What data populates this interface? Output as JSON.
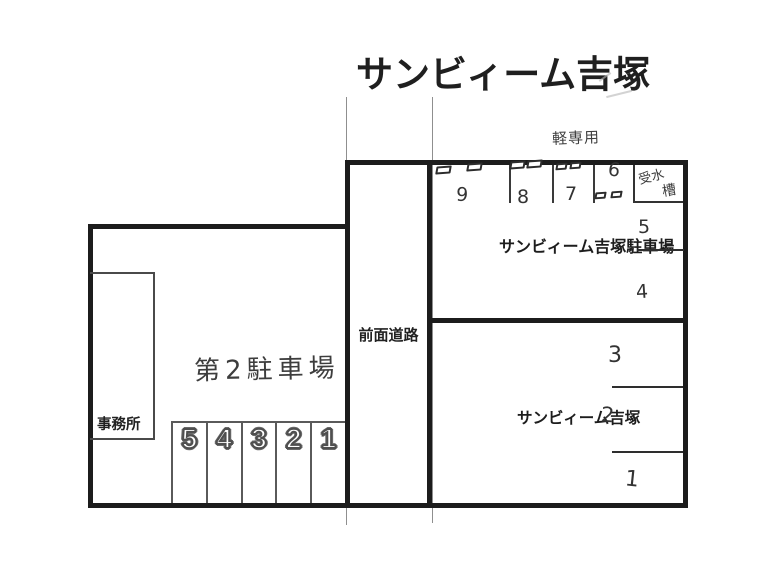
{
  "title": "サンビィーム吉塚",
  "road": {
    "label": "前面道路"
  },
  "left_block": {
    "office_label": "事務所",
    "area_label": "第2駐車場",
    "spaces": [
      "5",
      "4",
      "3",
      "2",
      "1"
    ]
  },
  "right_top_block": {
    "kei_only_label": "軽専用",
    "name": "サンビィーム吉塚駐車場",
    "kei_spaces": [
      "9",
      "8",
      "7",
      "6"
    ],
    "water_tank_parts": [
      "受水",
      "槽"
    ],
    "side_spaces": [
      "5",
      "4"
    ]
  },
  "right_bottom_block": {
    "name": "サンビィーム吉塚",
    "side_spaces": [
      "3",
      "2",
      "1"
    ]
  }
}
